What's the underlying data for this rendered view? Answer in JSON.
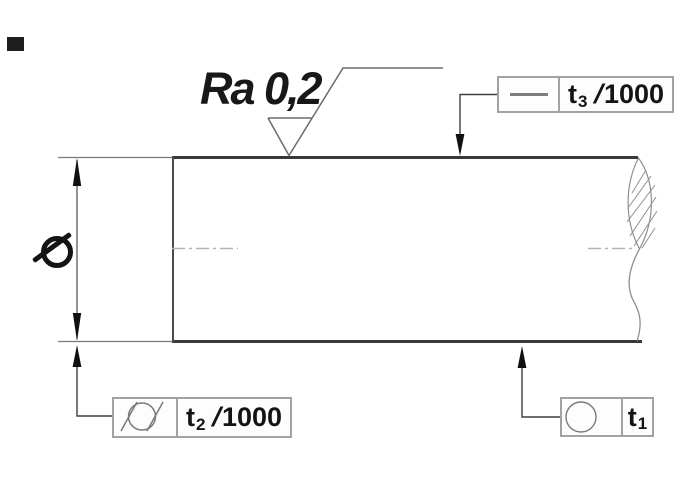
{
  "drawing": {
    "title": "shaft-tolerance-drawing",
    "roughness_label": "Ra 0,2",
    "diameter_symbol": "Ø",
    "frames": {
      "straightness": {
        "t": "t",
        "sub": "3",
        "slash": "/",
        "denom": "1000"
      },
      "cylindricity": {
        "t": "t",
        "sub": "2",
        "slash": "/",
        "denom": "1000"
      },
      "roundness": {
        "t": "t",
        "sub": "1"
      }
    },
    "icons": {
      "straightness": "straightness-line-icon",
      "cylindricity": "cylindricity-icon",
      "roundness": "roundness-circle-icon",
      "surface_finish": "machined-surface-icon"
    },
    "colors": {
      "outline_dark": "#383838",
      "thin_line": "#5a5a5a",
      "leader": "#3f3f3f",
      "frame_border": "#a2a2a2",
      "centerline": "#b3b3b3",
      "hatch": "#8f8f8f",
      "text": "#141414"
    }
  }
}
